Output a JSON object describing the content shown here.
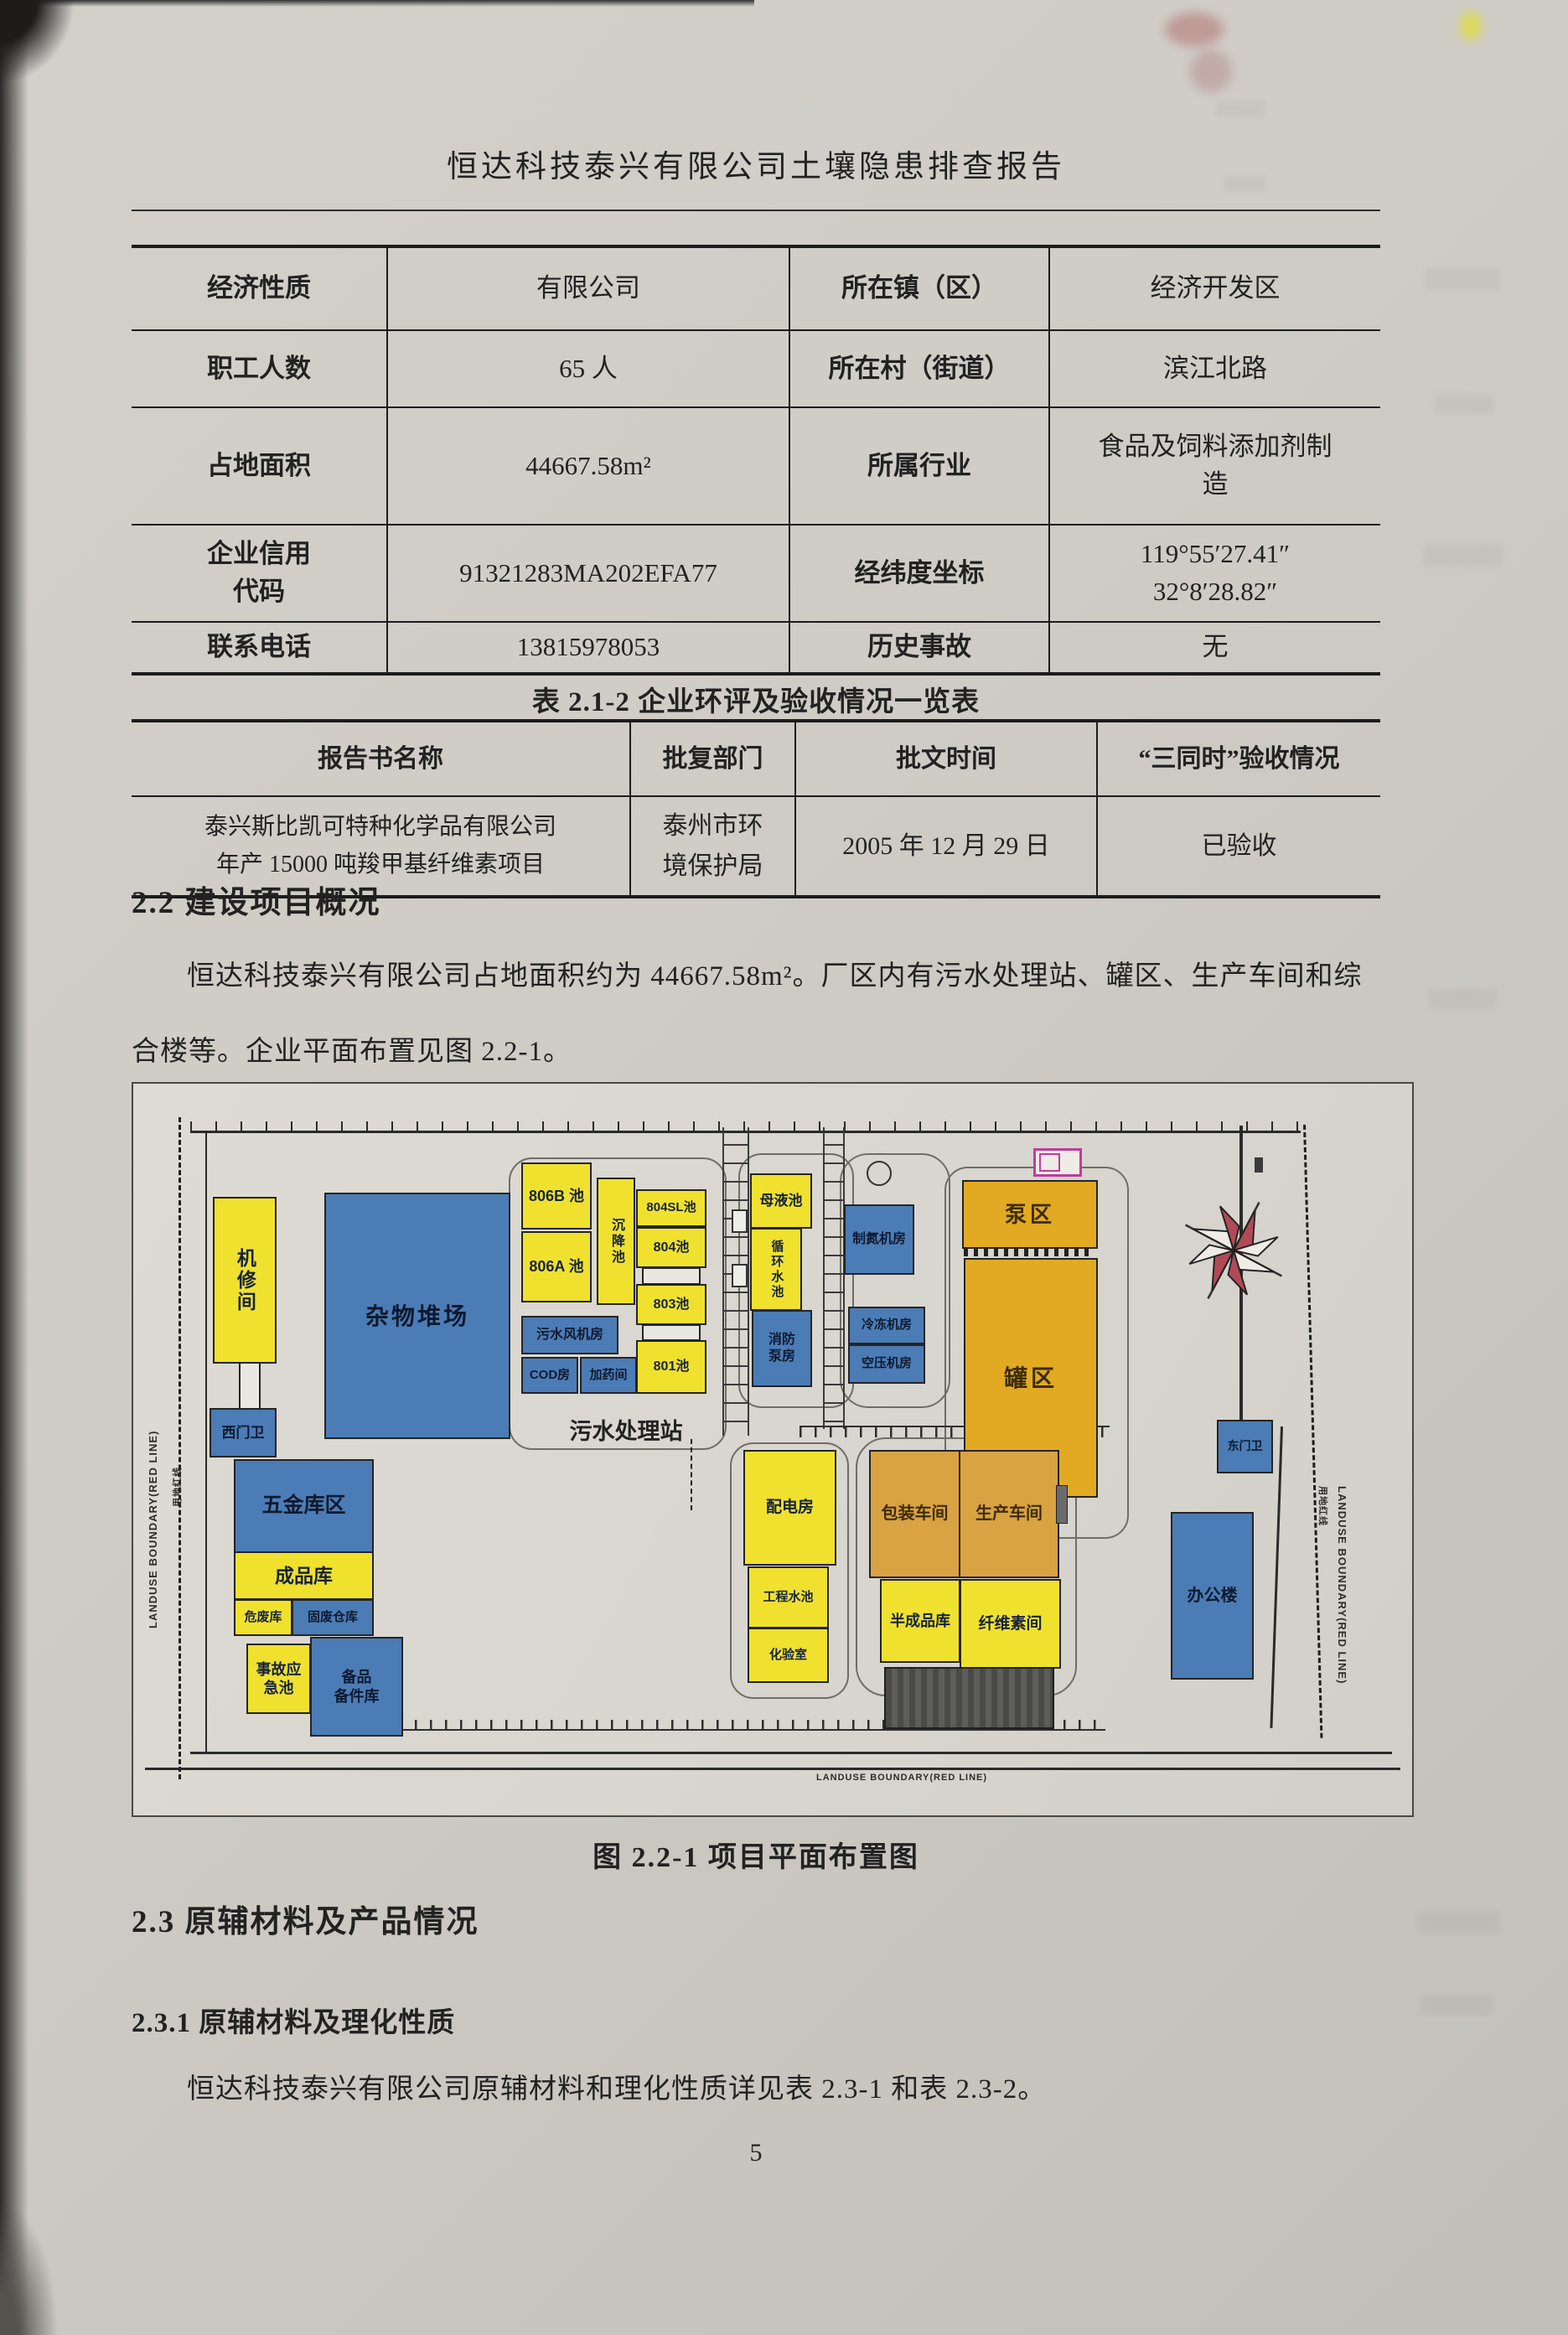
{
  "header": {
    "title": "恒达科技泰兴有限公司土壤隐患排查报告"
  },
  "info_table": {
    "rows": [
      {
        "label1": "经济性质",
        "value1": "有限公司",
        "label2": "所在镇（区）",
        "value2": "经济开发区"
      },
      {
        "label1": "职工人数",
        "value1": "65 人",
        "label2": "所在村（街道）",
        "value2": "滨江北路"
      },
      {
        "label1": "占地面积",
        "value1": "44667.58m²",
        "label2": "所属行业",
        "value2": "食品及饲料添加剂制\n造"
      },
      {
        "label1": "企业信用\n代码",
        "value1": "91321283MA202EFA77",
        "label2": "经纬度坐标",
        "value2": "119°55′27.41″\n32°8′28.82″"
      },
      {
        "label1": "联系电话",
        "value1": "13815978053",
        "label2": "历史事故",
        "value2": "无"
      }
    ]
  },
  "approval_table": {
    "caption": "表 2.1-2  企业环评及验收情况一览表",
    "headers": [
      "报告书名称",
      "批复部门",
      "批文时间",
      "“三同时”验收情况"
    ],
    "row": {
      "name": "泰兴斯比凯可特种化学品有限公司\n年产 15000 吨羧甲基纤维素项目",
      "dept": "泰州市环\n境保护局",
      "date": "2005 年 12 月 29 日",
      "status": "已验收"
    }
  },
  "section_22": {
    "heading": "2.2  建设项目概况",
    "paragraph": "恒达科技泰兴有限公司占地面积约为 44667.58m²。厂区内有污水处理站、罐区、生产车间和综合楼等。企业平面布置见图 2.2-1。"
  },
  "figure": {
    "caption": "图 2.2-1  项目平面布置图",
    "boundary_en": "LANDUSE BOUNDARY(RED LINE)",
    "boundary_cn": "用地红线",
    "labels": {
      "jixiujian": "机修间",
      "ximenwei": "西门卫",
      "zawuduichang": "杂物堆场",
      "c806b": "806B 池",
      "c806a": "806A 池",
      "chenjiangchi": "沉降池",
      "c804sl": "804SL池",
      "c804": "804池",
      "c803": "803池",
      "c801": "801池",
      "wushuifengjifang": "污水风机房",
      "codfang": "COD房",
      "jiayaojian": "加药间",
      "wushuichulizhan": "污水处理站",
      "muyechi": "母液池",
      "xunhuanshuichi": "循环水池",
      "xiaofangbengfang": "消防\n泵房",
      "zhidanjifang": "制氮机房",
      "lengdongjifang": "冷冻机房",
      "kongyajifang": "空压机房",
      "bengqu": "泵区",
      "guanqu": "罐区",
      "wujinkuqu": "五金库区",
      "chengpinku": "成品库",
      "weifeiku": "危废库",
      "gufeicangku": "固废仓库",
      "shiguyingjichi": "事故应\n急池",
      "beipinbeijianku": "备品\n备件库",
      "peidianfang": "配电房",
      "gongchengshuichi": "工程水池",
      "huayanshi": "化验室",
      "baozhuangchejian": "包装车间",
      "shengchanchejian": "生产车间",
      "banchengpinku": "半成品库",
      "xianweisujian": "纤维素间",
      "bangonglou": "办公楼",
      "dongmenwei": "东门卫"
    }
  },
  "section_23": {
    "heading": "2.3  原辅材料及产品情况",
    "sub_heading": "2.3.1 原辅材料及理化性质",
    "paragraph": "恒达科技泰兴有限公司原辅材料和理化性质详见表 2.3-1 和表 2.3-2。"
  },
  "footer": {
    "page_number": "5"
  }
}
